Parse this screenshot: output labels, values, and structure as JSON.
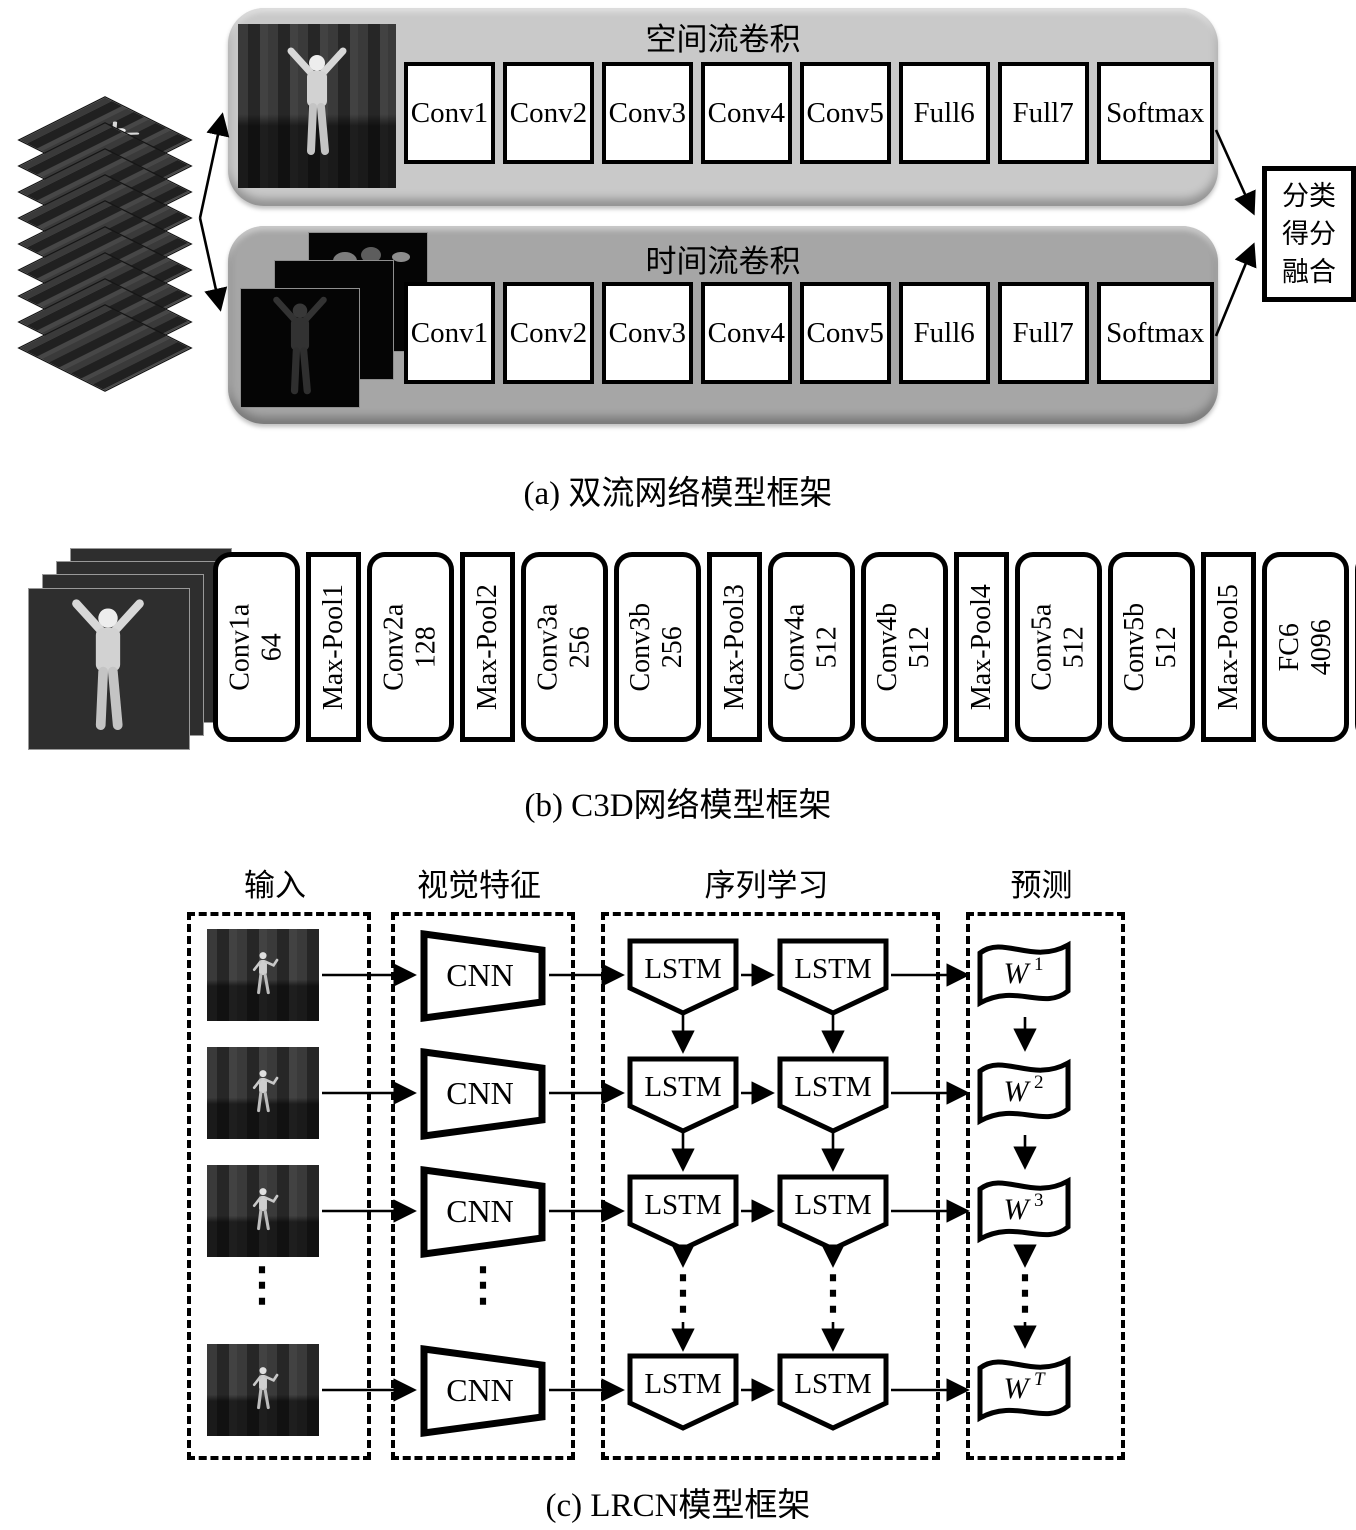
{
  "section_a": {
    "caption": "(a) 双流网络模型框架",
    "spatial": {
      "title": "空间流卷积",
      "layers": [
        "Conv1",
        "Conv2",
        "Conv3",
        "Conv4",
        "Conv5",
        "Full6",
        "Full7",
        "Softmax"
      ]
    },
    "temporal": {
      "title": "时间流卷积",
      "layers": [
        "Conv1",
        "Conv2",
        "Conv3",
        "Conv4",
        "Conv5",
        "Full6",
        "Full7",
        "Softmax"
      ]
    },
    "fusion": {
      "lines": [
        "分类",
        "得分",
        "融合"
      ]
    },
    "colors": {
      "spatial_panel": "#c9c9c9",
      "temporal_panel": "#a6a6a6"
    }
  },
  "section_b": {
    "caption": "(b) C3D网络模型框架",
    "layers": [
      {
        "name": "Conv1a",
        "size": "64",
        "type": "conv"
      },
      {
        "name": "Max-Pool1",
        "size": "",
        "type": "pool"
      },
      {
        "name": "Conv2a",
        "size": "128",
        "type": "conv"
      },
      {
        "name": "Max-Pool2",
        "size": "",
        "type": "pool"
      },
      {
        "name": "Conv3a",
        "size": "256",
        "type": "conv"
      },
      {
        "name": "Conv3b",
        "size": "256",
        "type": "conv"
      },
      {
        "name": "Max-Pool3",
        "size": "",
        "type": "pool"
      },
      {
        "name": "Conv4a",
        "size": "512",
        "type": "conv"
      },
      {
        "name": "Conv4b",
        "size": "512",
        "type": "conv"
      },
      {
        "name": "Max-Pool4",
        "size": "",
        "type": "pool"
      },
      {
        "name": "Conv5a",
        "size": "512",
        "type": "conv"
      },
      {
        "name": "Conv5b",
        "size": "512",
        "type": "conv"
      },
      {
        "name": "Max-Pool5",
        "size": "",
        "type": "pool"
      },
      {
        "name": "FC6",
        "size": "4096",
        "type": "conv"
      },
      {
        "name": "FC7",
        "size": "4096",
        "type": "conv"
      },
      {
        "name": "Softmax",
        "size": "",
        "type": "pool"
      }
    ]
  },
  "section_c": {
    "caption": "(c) LRCN模型框架",
    "headers": [
      "输入",
      "视觉特征",
      "序列学习",
      "预测"
    ],
    "cnn_label": "CNN",
    "lstm_label": "LSTM",
    "predictions": [
      {
        "base": "W",
        "sup": "1"
      },
      {
        "base": "W",
        "sup": "2"
      },
      {
        "base": "W",
        "sup": "3"
      },
      {
        "base": "W",
        "sup": "T"
      }
    ],
    "ellipsis": "⋮"
  }
}
